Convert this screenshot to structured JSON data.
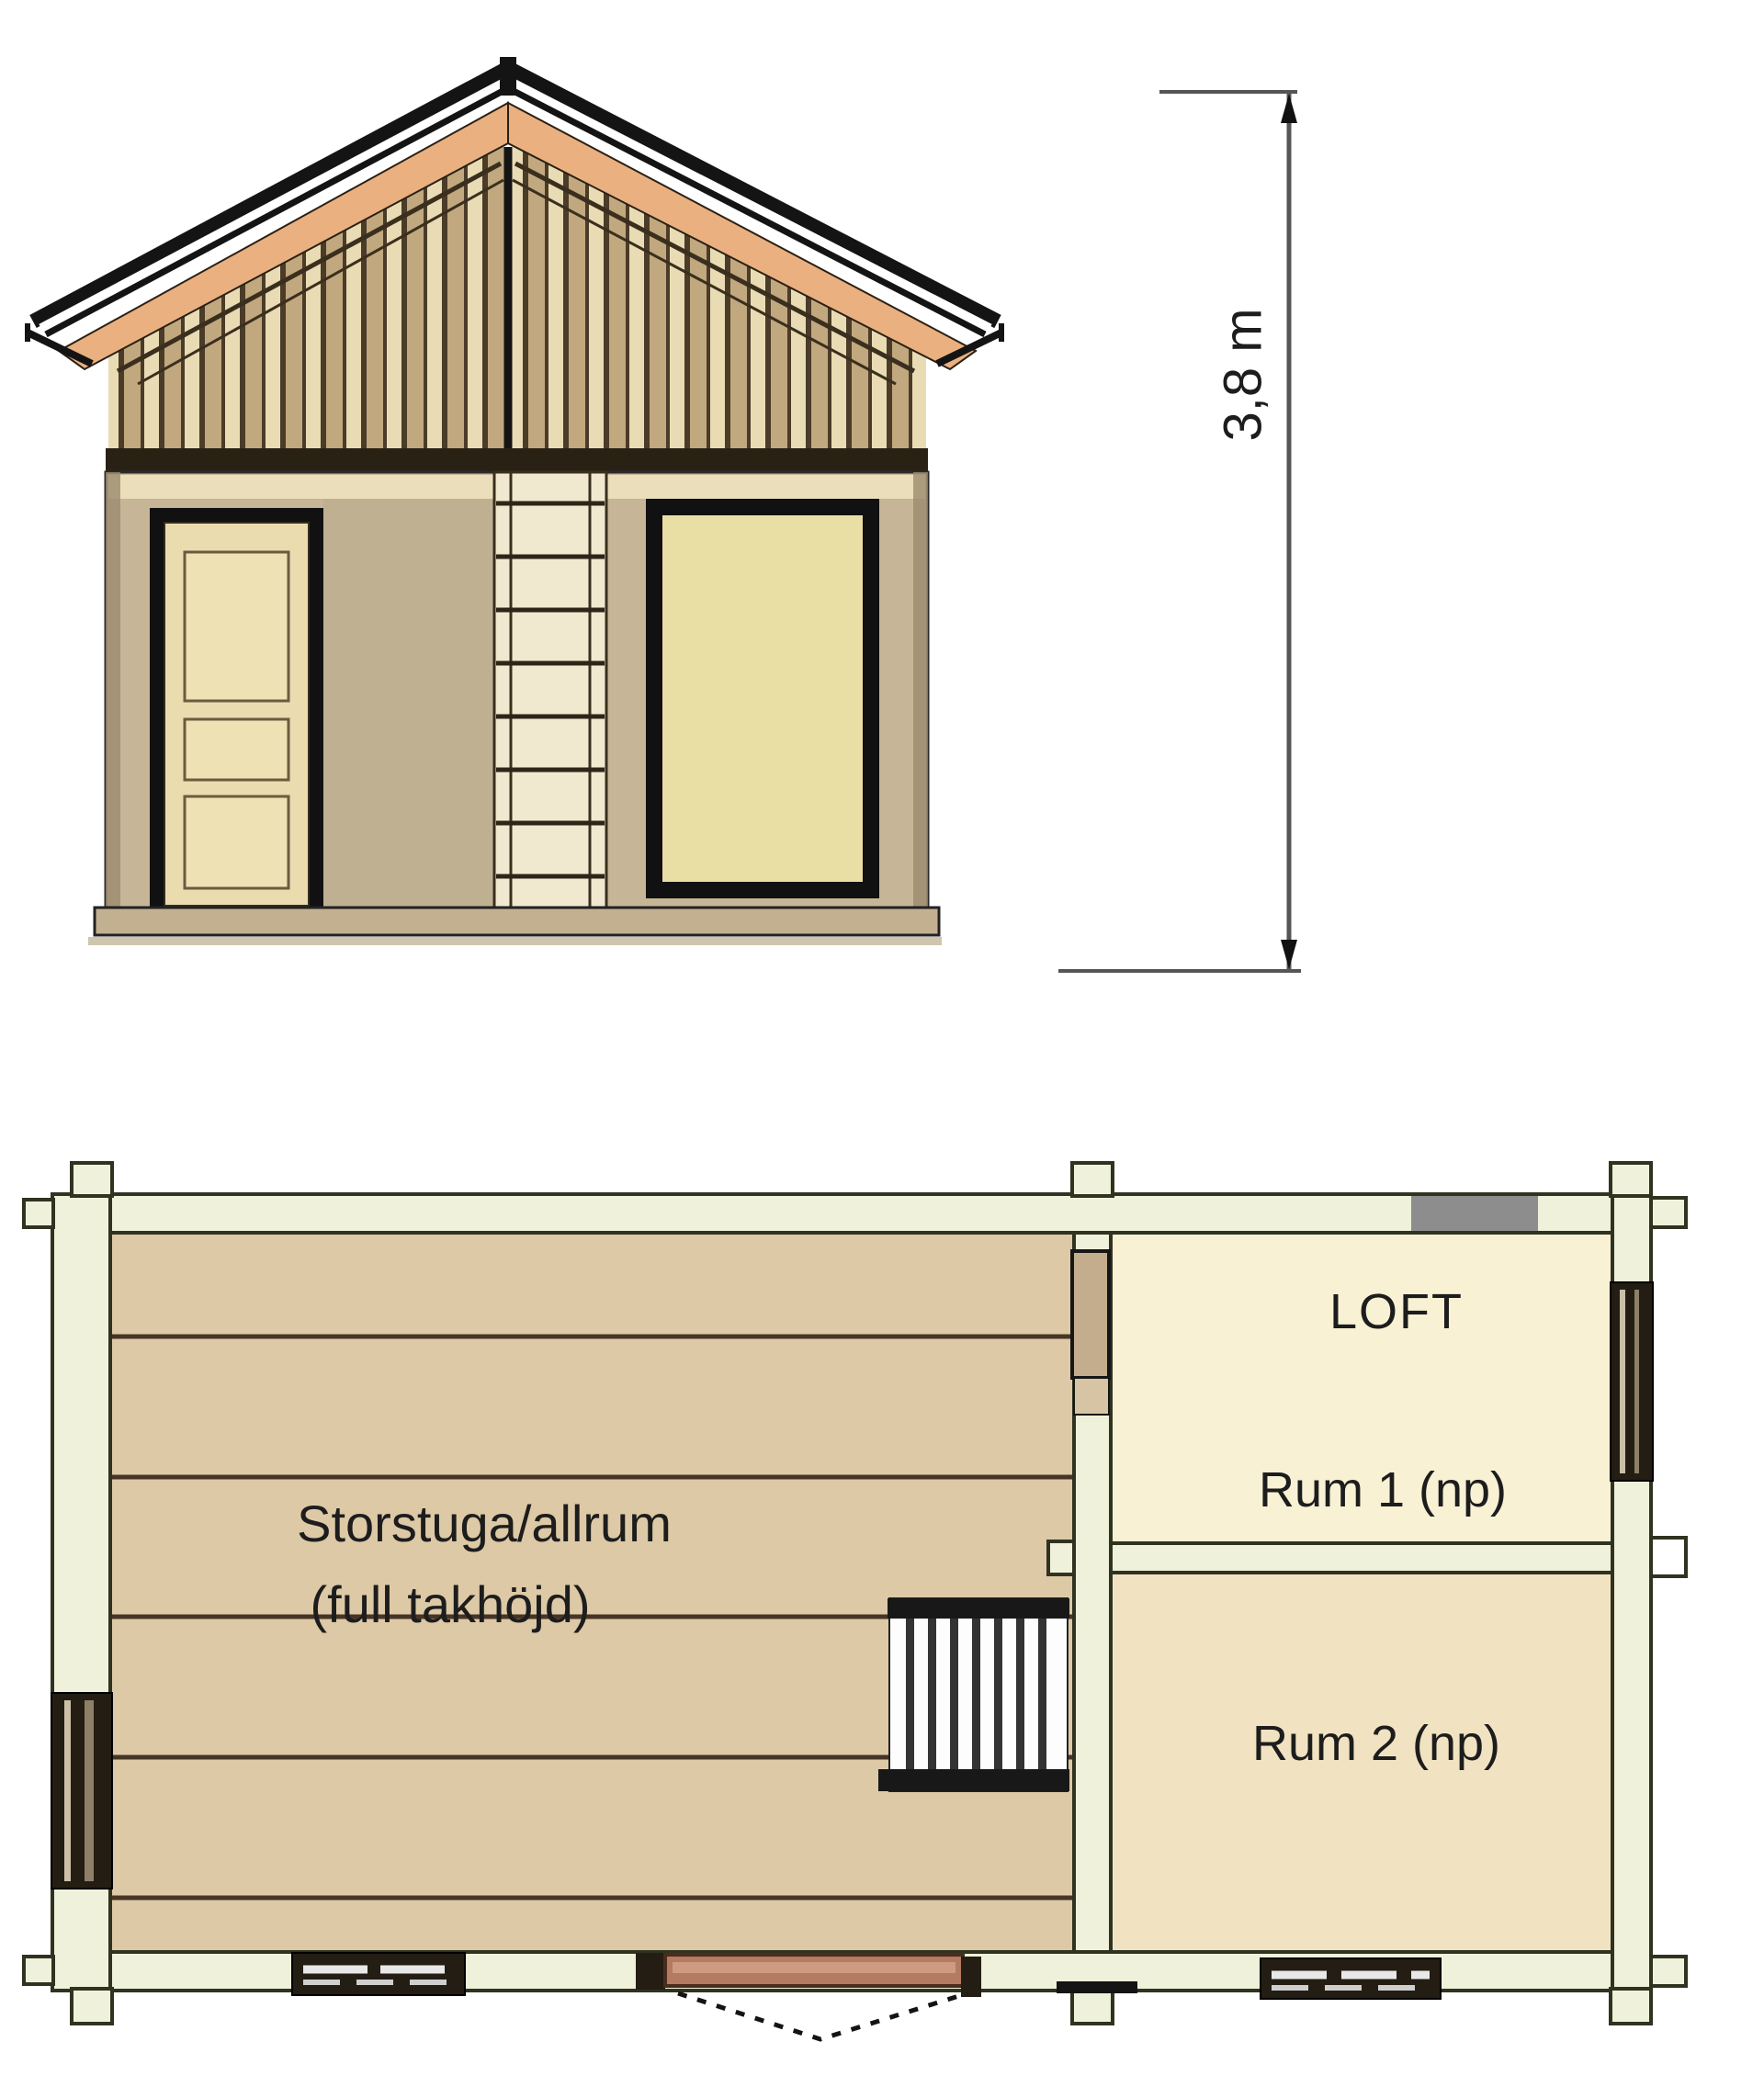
{
  "diagram": {
    "dimension_label": "3,8 m"
  },
  "plan_labels": {
    "storstuga_line1": "Storstuga/allrum",
    "storstuga_line2": "(full takhöjd)",
    "loft": "LOFT",
    "rum1": "Rum 1 (np)",
    "rum2": "Rum 2 (np)"
  },
  "colors": {
    "roof_outline": "#141414",
    "fascia_orange": "#eab080",
    "slat_tan": "#c2a87e",
    "slat_cream": "#e9dcb4",
    "slat_line": "#4a3c28",
    "loft_band_dark": "#2a2115",
    "wall_tan": "#c6b697",
    "wall_top_cream": "#eadfba",
    "door_cream": "#eadcae",
    "panel_cream": "#eee1b3",
    "window_cream": "#e9dfa5",
    "ladder_cream": "#f0e8cf",
    "base_tan": "#c3b091",
    "dim_line": "#555555",
    "text": "#1d1d1d",
    "plan_wall_fill": "#eff1da",
    "plan_wall_edge": "#2f3320",
    "floor_tan": "#ddc9a6",
    "floor_line": "#463526",
    "room_light": "#f8f1d4",
    "rum2_fill": "#f1e3c1",
    "window_gray": "#8d8d8d",
    "window_dark": "#241d13",
    "door_brown": "#b47a62",
    "stair_dark": "#181818"
  }
}
